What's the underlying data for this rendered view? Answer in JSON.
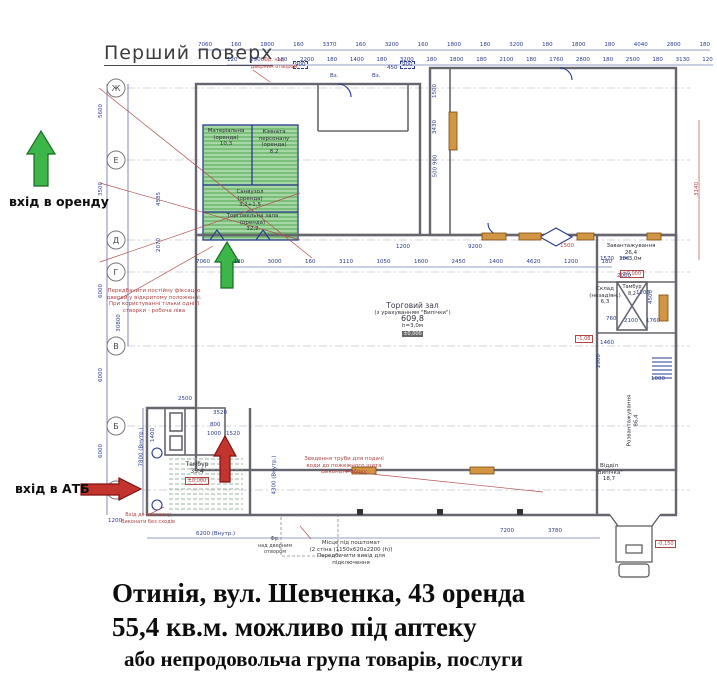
{
  "header": {
    "floor_title": "Перший поверх"
  },
  "caption": {
    "line1": "Отинія, вул. Шевченка, 43 оренда",
    "line2": "55,4 кв.м. можливо під аптеку",
    "line3": "або непродовольча група товарів, послуги"
  },
  "entrances": {
    "rent": "вхід в оренду",
    "atb": "вхід в АТБ"
  },
  "axes": {
    "letters": [
      "Ж",
      "Е",
      "Д",
      "Г",
      "В",
      "Б",
      "А"
    ]
  },
  "rent_rooms": {
    "material": {
      "line1": "Матеріальна",
      "line2": "(оренда)",
      "area": "10,3"
    },
    "staff": {
      "line1": "Кімната",
      "line2": "персоналу",
      "line3": "(оренда)",
      "area": "8,2"
    },
    "wc": {
      "line1": "Санвузол",
      "line2": "(оренда)",
      "area": "3,2+1,5"
    },
    "trade": {
      "line1": "Торговельна зала",
      "line2": "(оренда)",
      "area": "32,2"
    }
  },
  "rooms": {
    "main_hall": {
      "name": "Торговий зал",
      "note": "(з урахуванням \"Випічки\")",
      "area": "609,8",
      "height": "h=3,0м"
    },
    "loading": {
      "name": "Завантажування",
      "area": "26,4",
      "height": "h=3,0м"
    },
    "storage": {
      "line1": "Склад",
      "line2": "(незадіян.)",
      "area": "6,3"
    },
    "hoist": {
      "name": "Тамбур",
      "area": "8,2"
    },
    "unloading": {
      "name": "Розвантажування",
      "area": "86,4"
    },
    "bakery": {
      "line1": "Відділ",
      "line2": "\"Випічка\"",
      "area": "18,7"
    },
    "tambour": {
      "name": "Тамбур",
      "area": "35,4"
    }
  },
  "levels": {
    "zero": "±0,000",
    "dock": "-0,150",
    "pit": "-1,08"
  },
  "notes": {
    "door_fix": [
      "Передбачити постійну фіксацію",
      "дверей у відкритому положенні.",
      "При користуванні тільки однієї",
      "створки - робоча ліва"
    ],
    "fire_pipe": [
      "Зведення труби для подачі",
      "води до пожежного щита",
      "Виконати збоку"
    ],
    "entrance": [
      "Вхід до магазину",
      "Виконати без сходів"
    ],
    "postomat": [
      "Місце під поштомат",
      "(2 стіна (1150х620х2200 (h))",
      "Передбачити вивід для",
      "підключення"
    ],
    "fr_top": [
      "Фр. над",
      "дверним отвором"
    ],
    "fr_bottom": [
      "Фр.",
      "над дверним",
      "отвором"
    ]
  },
  "dims": {
    "top1": [
      "7060",
      "160",
      "1800",
      "160",
      "3370",
      "160",
      "3200",
      "160",
      "1800",
      "180",
      "3200",
      "180",
      "1800",
      "180",
      "4040",
      "2800",
      "180"
    ],
    "top2": [
      "120",
      "2900",
      "180",
      "2200",
      "180",
      "1400",
      "180",
      "3200",
      "180",
      "1800",
      "180",
      "2100",
      "180",
      "1760",
      "2800",
      "180",
      "2500",
      "180",
      "3130",
      "120"
    ],
    "mid": [
      "7060",
      "180",
      "3000",
      "160",
      "3110",
      "1050",
      "1600",
      "2450",
      "1400",
      "4620",
      "1200",
      "180"
    ],
    "scatter": [
      "5600",
      "3500",
      "6000",
      "6000",
      "6000",
      "30800",
      "4585",
      "2070",
      "7800 (Внутр.)",
      "4300 (Внутр.)",
      "3140",
      "6200 (Внутр.)",
      "7200",
      "3780",
      "2500",
      "3520",
      "800",
      "1000",
      "1520",
      "1400",
      "2000",
      "4500",
      "1200",
      "2100",
      "1760",
      "760",
      "1570",
      "180",
      "1460",
      "2900",
      "1500",
      "900",
      "450",
      "900",
      "1200",
      "9200",
      "1500",
      "3430",
      "500 900",
      "1000",
      "1200",
      "Вз.",
      "Вз."
    ]
  },
  "colors": {
    "rent_green": "#a6d8a6",
    "arrow_green": "#3cb549",
    "arrow_red": "#c4342e",
    "annotation_red": "#b04343",
    "plan_navy": "#2a3a8c",
    "wall_gray": "#66666e"
  }
}
